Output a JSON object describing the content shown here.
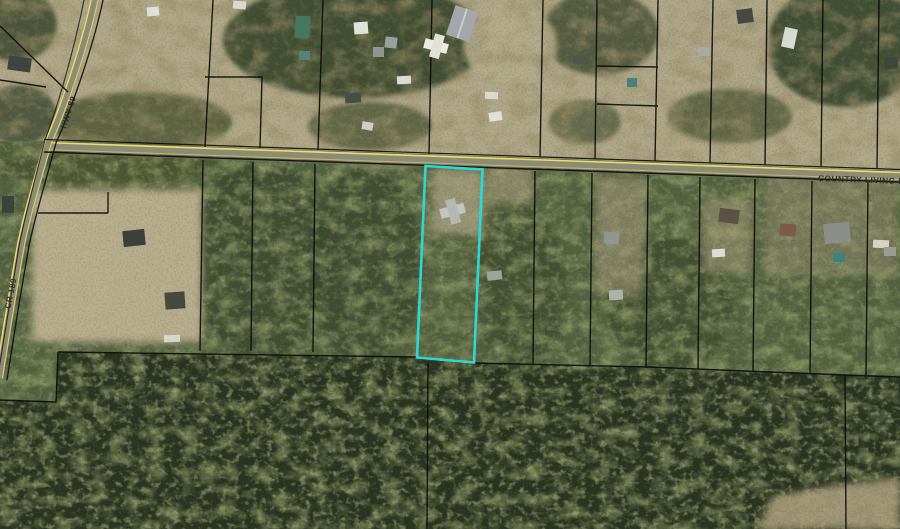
{
  "map": {
    "description": "Aerial parcel map with a highlighted survey lot",
    "roads": [
      {
        "id": "hwy-89",
        "label": "HWY 89"
      },
      {
        "id": "cr-189",
        "label": "CR 189"
      },
      {
        "id": "country-living-rd",
        "label": "COUNTRY LIVING R"
      }
    ],
    "highlight": {
      "name": "selected-parcel",
      "color": "#2BD8D6",
      "points": "425.5,166 482.5,169.5 474,362.5 417,357.5"
    },
    "colors": {
      "parcel_line": "#0e0e0e",
      "road_stripe": "#e6e06a",
      "road_surface": "#8d8a76",
      "field": "#b2a98a",
      "forest_mid": "#556341",
      "forest_dark": "#2b3522",
      "label_text": "#2b2b24"
    }
  }
}
